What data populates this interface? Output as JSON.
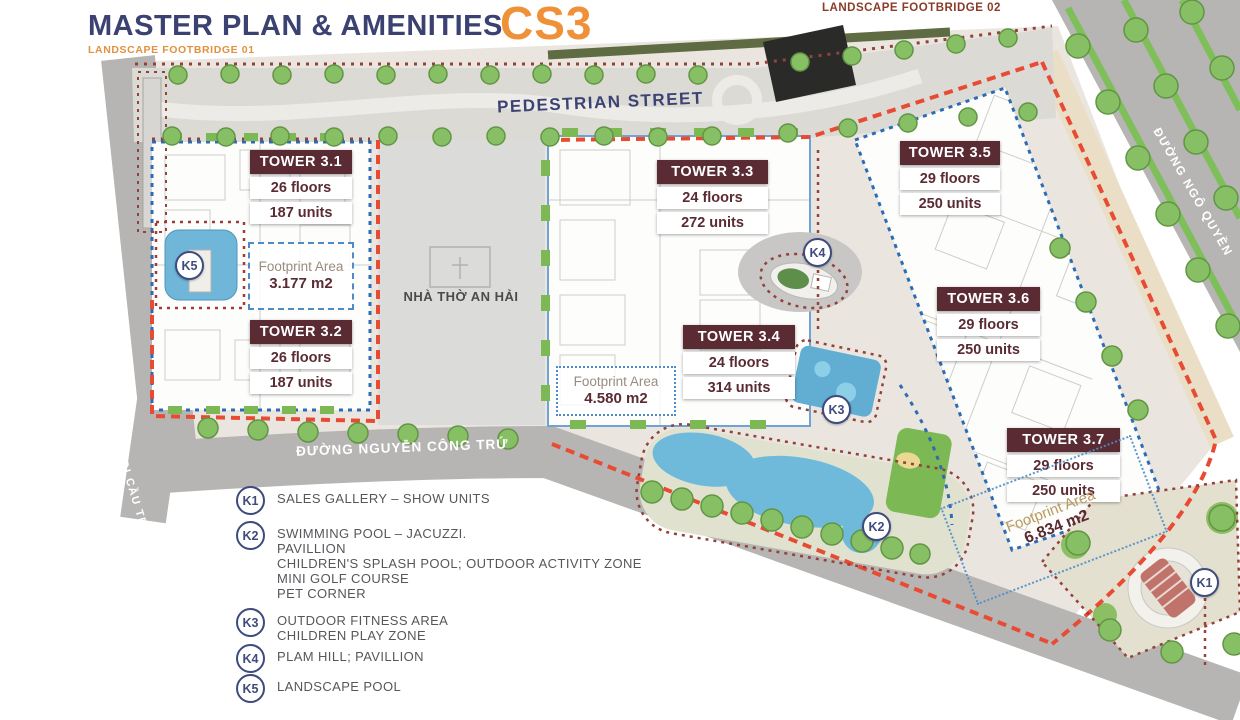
{
  "header": {
    "title": "MASTER PLAN & AMENITIES",
    "logo": "CS3",
    "footbridge_01": "LANDSCAPE FOOTBRIDGE 01",
    "footbridge_02": "LANDSCAPE FOOTBRIDGE 02"
  },
  "streets": {
    "pedestrian": "PEDESTRIAN STREET",
    "nguyen_cong_tru": "ĐƯỜNG NGUYỄN CÔNG TRỨ",
    "tran_thi_ly": "ĐI CẦU TRẦN THỊ LÝ",
    "ngo_quyen": "ĐƯỜNG NGÔ QUYỀN"
  },
  "church": {
    "label": "NHÀ THỜ AN HẢI"
  },
  "towers": [
    {
      "name": "TOWER 3.1",
      "floors": "26 floors",
      "units": "187 units"
    },
    {
      "name": "TOWER 3.2",
      "floors": "26 floors",
      "units": "187 units"
    },
    {
      "name": "TOWER 3.3",
      "floors": "24 floors",
      "units": "272 units"
    },
    {
      "name": "TOWER 3.4",
      "floors": "24 floors",
      "units": "314 units"
    },
    {
      "name": "TOWER 3.5",
      "floors": "29 floors",
      "units": "250 units"
    },
    {
      "name": "TOWER 3.6",
      "floors": "29 floors",
      "units": "250 units"
    },
    {
      "name": "TOWER 3.7",
      "floors": "29 floors",
      "units": "250 units"
    }
  ],
  "footprints": [
    {
      "label": "Footprint Area",
      "value": "3.177 m2"
    },
    {
      "label": "Footprint Area",
      "value": "4.580 m2"
    },
    {
      "label": "Footprint Area",
      "value": "6.834 m2"
    }
  ],
  "markers": [
    "K1",
    "K2",
    "K3",
    "K4",
    "K5"
  ],
  "legend": [
    {
      "key": "K1",
      "lines": [
        "SALES GALLERY – SHOW UNITS"
      ]
    },
    {
      "key": "K2",
      "lines": [
        "SWIMMING POOL – JACUZZI.",
        "PAVILLION",
        "CHILDREN'S SPLASH POOL; OUTDOOR ACTIVITY ZONE",
        "MINI GOLF COURSE",
        "PET CORNER"
      ]
    },
    {
      "key": "K3",
      "lines": [
        "OUTDOOR FITNESS AREA",
        "CHILDREN PLAY ZONE"
      ]
    },
    {
      "key": "K4",
      "lines": [
        "PLAM HILL; PAVILLION"
      ]
    },
    {
      "key": "K5",
      "lines": [
        "LANDSCAPE POOL"
      ]
    }
  ],
  "colors": {
    "title_navy": "#3b4171",
    "logo_orange": "#ef9138",
    "tower_maroon": "#5a2b33",
    "boundary_red": "#e84b33",
    "plot_blue": "#2d6cb5",
    "amenity_maroon_dot": "#93423a",
    "pool_blue": "#6fb9da",
    "tree_green": "#87c064"
  }
}
